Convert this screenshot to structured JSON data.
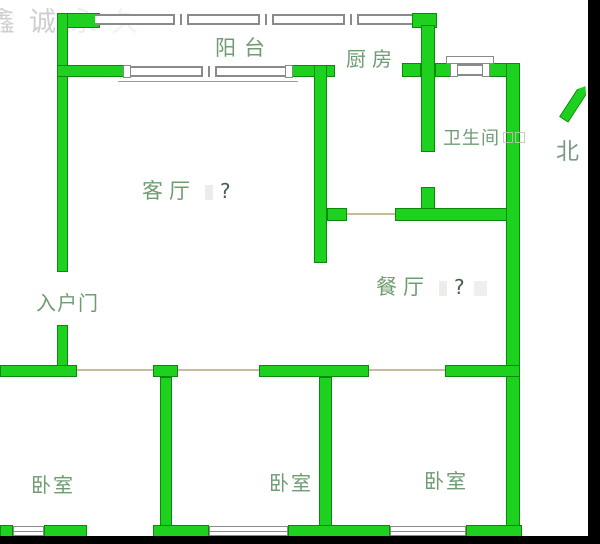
{
  "labels": {
    "balcony": "阳台",
    "kitchen": "厨房",
    "bathroom": "卫生间",
    "living": "客厅",
    "living_question": "?",
    "dining": "餐厅",
    "dining_question": "?",
    "entrance": "入户门",
    "bedroom": "卧室",
    "north": "北"
  },
  "watermark": {
    "char1": "鑫",
    "char2": "诚",
    "char3": "永",
    "char4": "久"
  },
  "colors": {
    "wall_fill": "#1fd11f",
    "wall_border": "#0a8a0a",
    "window_line": "#8a8a8a",
    "door_line": "#c9bc9b",
    "label_green": "#6f9c72",
    "frame_black": "#000000",
    "background": "#ffffff"
  },
  "plan": {
    "walls": [
      [
        57,
        13,
        43,
        15
      ],
      [
        412,
        13,
        25,
        15
      ],
      [
        57,
        13,
        11,
        259
      ],
      [
        57,
        325,
        11,
        52
      ],
      [
        57,
        65,
        68,
        12
      ],
      [
        290,
        65,
        45,
        12
      ],
      [
        314,
        65,
        13,
        198
      ],
      [
        402,
        63,
        19,
        14
      ],
      [
        435,
        63,
        17,
        14
      ],
      [
        488,
        63,
        29,
        14
      ],
      [
        421,
        25,
        14,
        127
      ],
      [
        421,
        187,
        14,
        34
      ],
      [
        327,
        208,
        20,
        13
      ],
      [
        395,
        208,
        115,
        13
      ],
      [
        506,
        63,
        14,
        474
      ],
      [
        0,
        365,
        77,
        12
      ],
      [
        153,
        365,
        25,
        12
      ],
      [
        259,
        365,
        110,
        12
      ],
      [
        445,
        365,
        75,
        12
      ],
      [
        160,
        377,
        12,
        160
      ],
      [
        319,
        377,
        13,
        160
      ],
      [
        0,
        525,
        13,
        12
      ],
      [
        44,
        525,
        43,
        12
      ],
      [
        153,
        525,
        56,
        12
      ],
      [
        288,
        525,
        102,
        12
      ],
      [
        466,
        525,
        56,
        12
      ]
    ],
    "windows_band": [
      {
        "x": 95,
        "y": 14,
        "w": 317,
        "h": 11,
        "mullions": [
          173,
          258,
          343
        ]
      },
      {
        "x": 123,
        "y": 66,
        "w": 170,
        "h": 11,
        "mullions": [
          201
        ],
        "caps": true,
        "sill": true
      },
      {
        "x": 450,
        "y": 64,
        "w": 40,
        "h": 12,
        "caps": true,
        "lintel": true
      }
    ],
    "windows_mid": [
      {
        "x": 13,
        "y": 526,
        "w": 31,
        "h": 10
      },
      {
        "x": 209,
        "y": 526,
        "w": 79,
        "h": 10
      },
      {
        "x": 390,
        "y": 526,
        "w": 76,
        "h": 10
      }
    ],
    "door_lines": [
      {
        "x": 77,
        "y": 369,
        "w": 76
      },
      {
        "x": 178,
        "y": 369,
        "w": 81
      },
      {
        "x": 369,
        "y": 369,
        "w": 76
      },
      {
        "x": 347,
        "y": 213,
        "w": 48
      }
    ],
    "north_arrow": {
      "x": 569,
      "y": 83,
      "w": 11,
      "h": 40,
      "angle": 33
    }
  }
}
